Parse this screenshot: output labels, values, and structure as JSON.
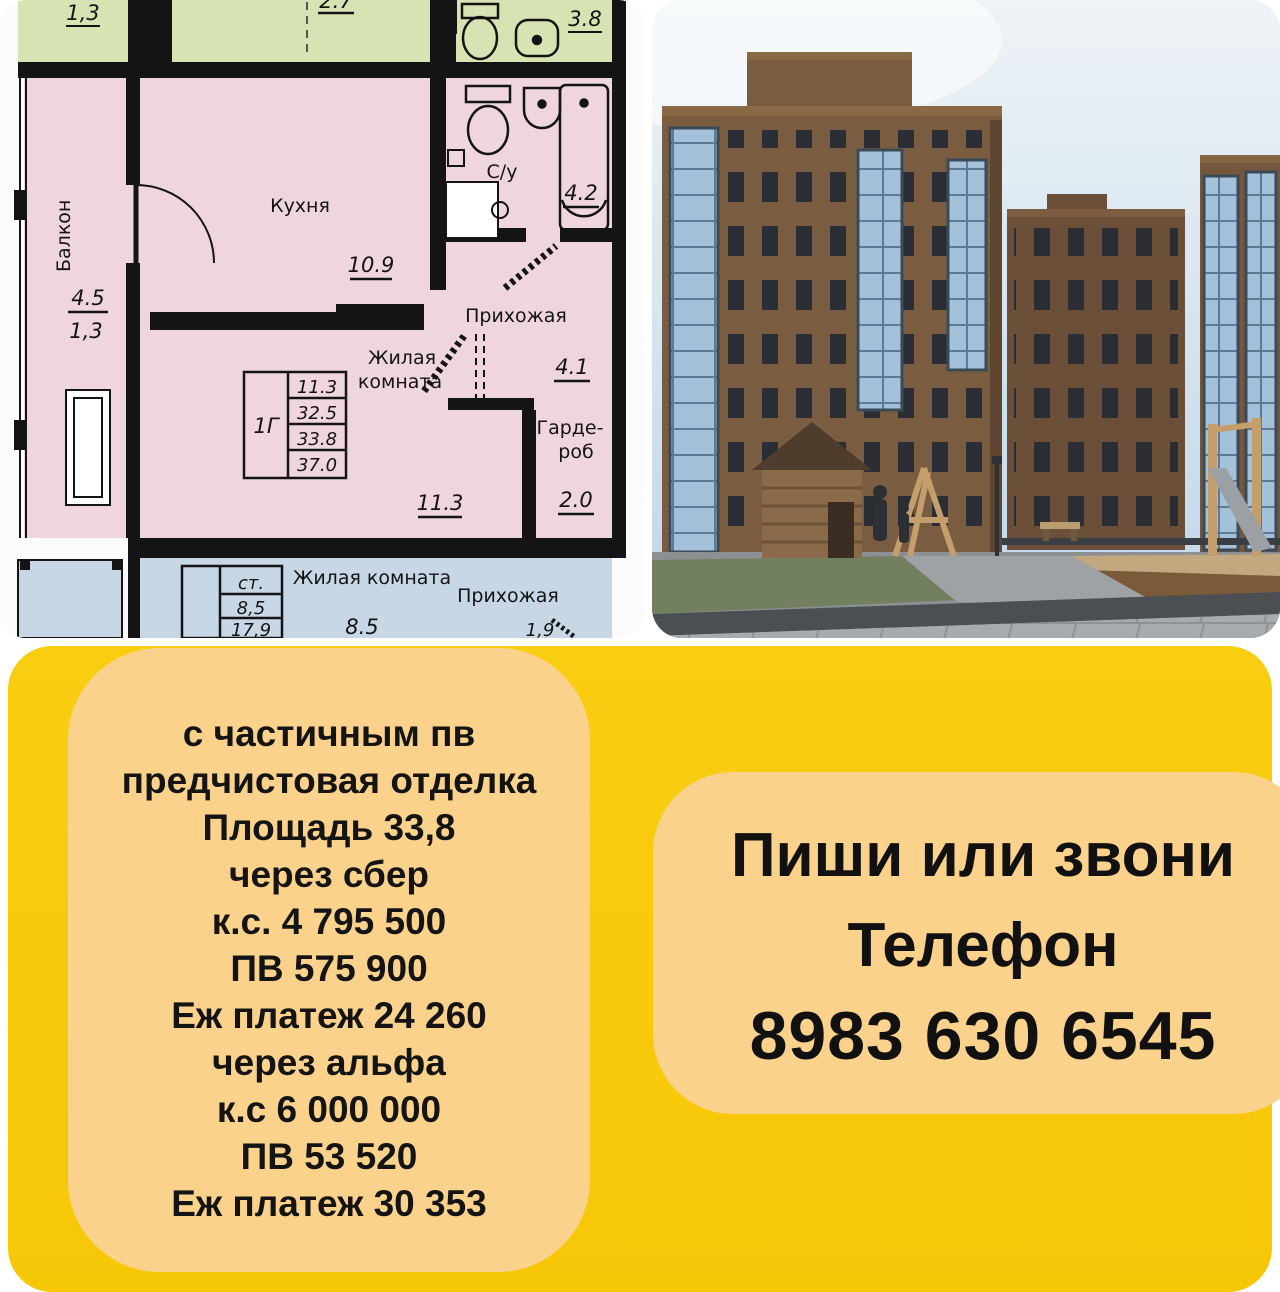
{
  "plan": {
    "green_room_area": "1,3",
    "green_top_area": "2.7",
    "green_bath_area": "3.8",
    "balcony_label": "Балкон",
    "balcony_area_top": "4.5",
    "balcony_area_bottom": "1,3",
    "kitchen_label": "Кухня",
    "kitchen_area": "10.9",
    "bath_label": "С/у",
    "bath_area": "4.2",
    "hall_label": "Прихожая",
    "hall_area": "4.1",
    "living_label_line1": "Жилая",
    "living_label_line2": "комната",
    "living_area": "11.3",
    "wardrobe_label_line1": "Гарде-",
    "wardrobe_label_line2": "роб",
    "wardrobe_area": "2.0",
    "unit_table": {
      "unit_type": "1Г",
      "living_area": "11.3",
      "area2": "32.5",
      "area3": "33.8",
      "area4": "37.0"
    },
    "lower_unit": {
      "st_label": "ст.",
      "st_area1": "8,5",
      "st_area2": "17,9",
      "living_label": "Жилая комната",
      "living_area": "8.5",
      "hall_label": "Прихожая",
      "hall_area": "1,9"
    }
  },
  "offer": {
    "lines": [
      "с частичным пв",
      "предчистовая отделка",
      "Площадь 33,8",
      "через сбер",
      "к.с. 4 795 500",
      "ПВ 575 900",
      "Еж платеж 24 260",
      "",
      "через альфа",
      "к.с 6 000 000",
      "ПВ 53 520",
      "Еж платеж 30 353"
    ]
  },
  "contact": {
    "headline": "Пиши или звони",
    "phone_label": "Телефон",
    "phone": "8983 630 6545"
  },
  "colors": {
    "promo_yellow": "#f7ca10",
    "promo_card": "#fbd28c",
    "text_dark": "#141414",
    "plan_green": "#d8e3b4",
    "plan_pink": "#eed5df",
    "plan_blue": "#c8d7e5",
    "plan_wall": "#141414",
    "photo_sky": "#c3d9ea",
    "photo_brick": "#7a5c40"
  }
}
